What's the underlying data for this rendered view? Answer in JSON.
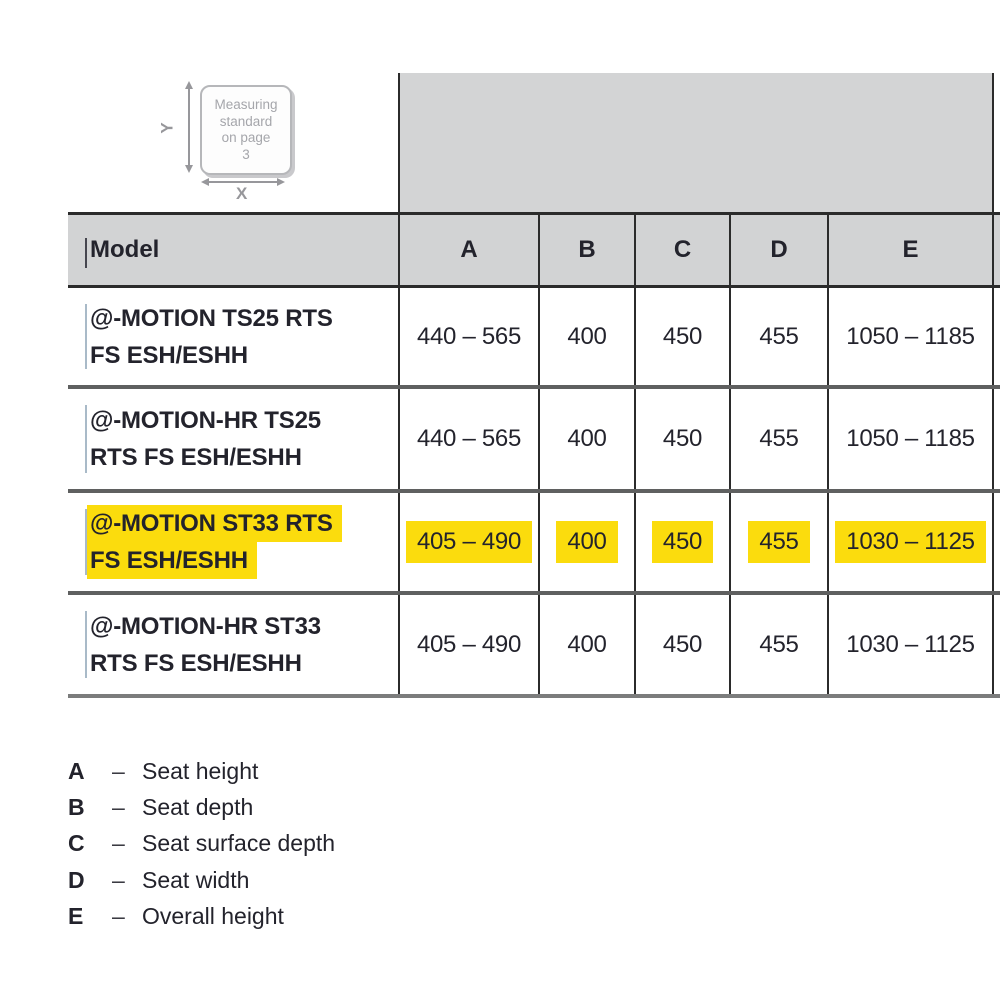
{
  "diagram": {
    "badge_lines": [
      "Measuring",
      "standard",
      "on page",
      "3"
    ],
    "y_label": "Y",
    "x_label": "X"
  },
  "table": {
    "header": {
      "model": "Model",
      "a": "A",
      "b": "B",
      "c": "C",
      "d": "D",
      "e": "E"
    },
    "rows": [
      {
        "model_line1": "@-MOTION TS25 RTS",
        "model_line2": "FS ESH/ESHH",
        "a": "440 – 565",
        "b": "400",
        "c": "450",
        "d": "455",
        "e": "1050 – 1185",
        "highlighted": false
      },
      {
        "model_line1": "@-MOTION-HR TS25",
        "model_line2": "RTS FS ESH/ESHH",
        "a": "440 – 565",
        "b": "400",
        "c": "450",
        "d": "455",
        "e": "1050 – 1185",
        "highlighted": false
      },
      {
        "model_line1": "@-MOTION ST33 RTS",
        "model_line2": "FS ESH/ESHH",
        "a": "405 – 490",
        "b": "400",
        "c": "450",
        "d": "455",
        "e": "1030 – 1125",
        "highlighted": true
      },
      {
        "model_line1": "@-MOTION-HR ST33",
        "model_line2": "RTS FS ESH/ESHH",
        "a": "405 – 490",
        "b": "400",
        "c": "450",
        "d": "455",
        "e": "1030 – 1125",
        "highlighted": false
      }
    ]
  },
  "legend": {
    "items": [
      {
        "key": "A",
        "dash": "–",
        "label": "Seat height"
      },
      {
        "key": "B",
        "dash": "–",
        "label": "Seat depth"
      },
      {
        "key": "C",
        "dash": "–",
        "label": "Seat surface depth"
      },
      {
        "key": "D",
        "dash": "–",
        "label": "Seat width"
      },
      {
        "key": "E",
        "dash": "–",
        "label": "Overall height"
      }
    ]
  },
  "colors": {
    "highlight": "#fbdc0d",
    "header_bg": "#d2d3d4",
    "image_block_bg": "#d3d4d5",
    "text": "#23232c",
    "border_dark": "#2b2b2b",
    "row_separator": "#5f6060",
    "bottom_border": "#7b7c7c",
    "badge_text": "#a5a6ab",
    "arrow": "#97979b"
  }
}
